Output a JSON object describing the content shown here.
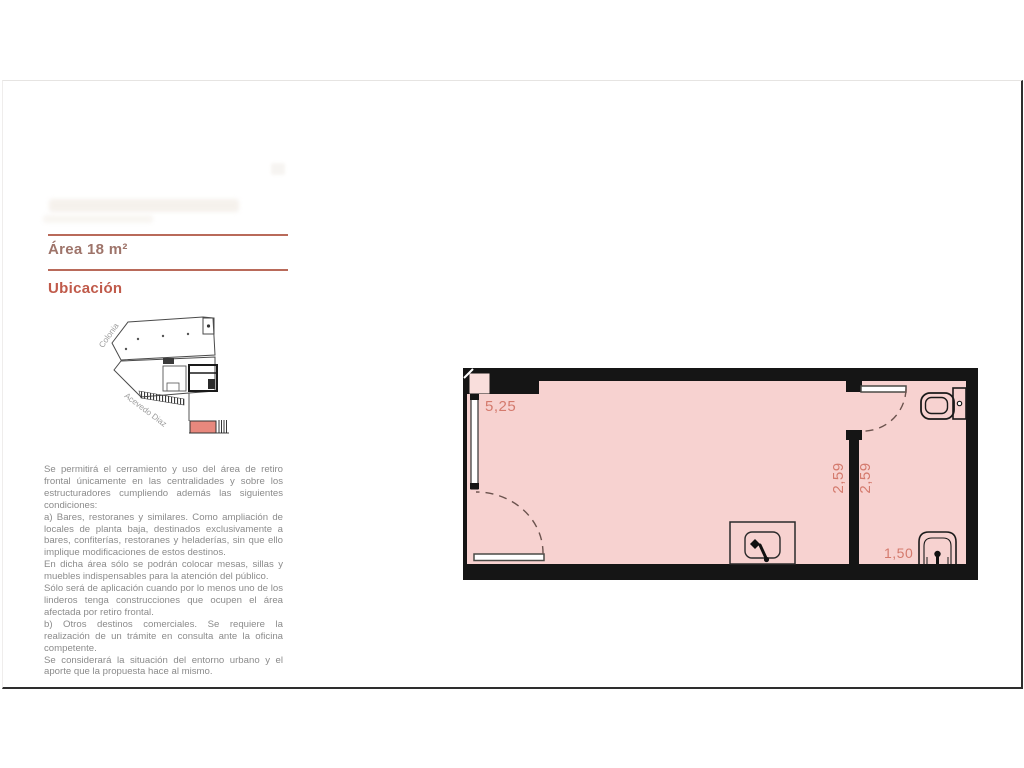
{
  "document": {
    "area_title": "Área 18 m²",
    "location_heading": "Ubicación",
    "regulations": [
      "Se permitirá el cerramiento y uso del área de retiro frontal únicamente en las centralidades y sobre los estructuradores cumpliendo además las siguientes condiciones:",
      "a) Bares, restoranes y similares. Como ampliación de locales de planta baja, destinados exclusivamente a bares, confiterías, restoranes y heladerías, sin que ello implique modificaciones de estos destinos.",
      "En dicha área sólo se podrán colocar mesas, sillas y muebles indispensables para la atención del público.",
      "Sólo será de aplicación cuando por lo menos uno de los linderos tenga construcciones que ocupen el área afectada por retiro frontal.",
      "b) Otros destinos comerciales. Se requiere la realización de un trámite en consulta ante la oficina competente.",
      "Se considerará la situación del entorno urbano y el aporte que la propuesta hace al mismo."
    ]
  },
  "site_map": {
    "street_colonia": "Colonia",
    "street_acevedo": "Acevedo Diaz",
    "unit_highlight_color": "#e8887d"
  },
  "floor_plan": {
    "dim_front": "5,25",
    "dim_room_depth": "2,59",
    "dim_bath_depth": "2,59",
    "dim_bath_width": "1,50",
    "room_fill_color": "#f7d2d0",
    "wall_color": "#151515",
    "dimension_color": "#d47a6d"
  },
  "accent_color": "#c05a4a"
}
